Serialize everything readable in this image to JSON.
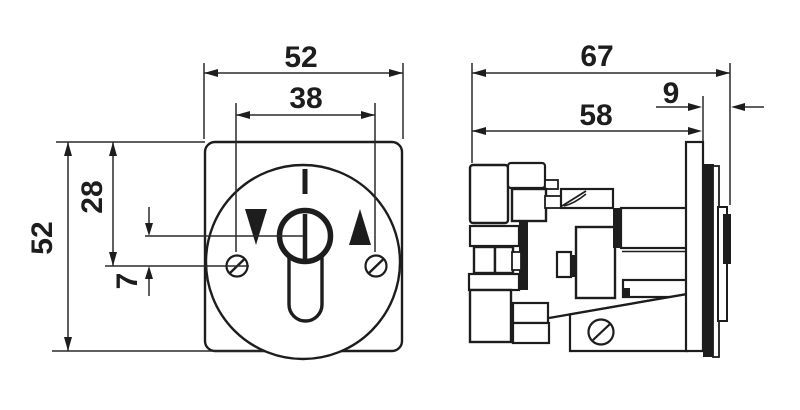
{
  "drawing": {
    "front_view": {
      "width_mm": "52",
      "screw_spacing_mm": "38",
      "height_mm": "52",
      "edge_to_screw_mm": "28",
      "center_to_screw_mm": "7"
    },
    "side_view": {
      "total_depth_mm": "67",
      "body_depth_mm": "58",
      "bezel_depth_mm": "9"
    },
    "colors": {
      "line": "#1d1d1d",
      "background": "#ffffff"
    }
  }
}
